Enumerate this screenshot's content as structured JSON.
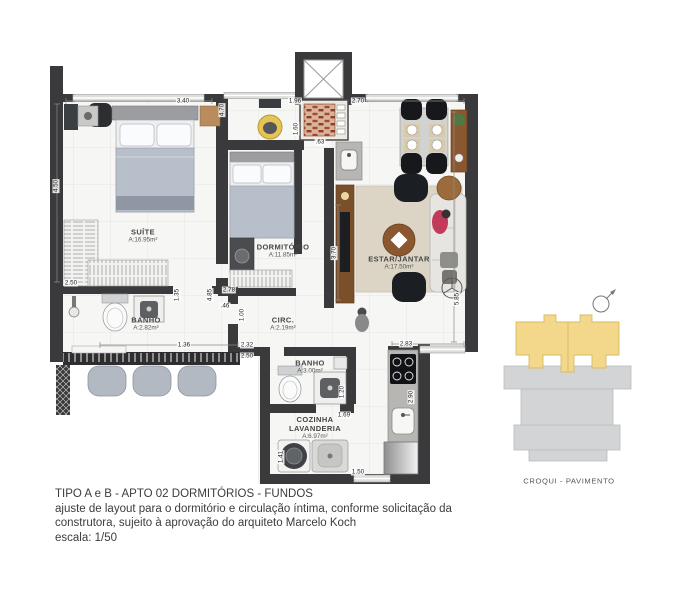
{
  "plan": {
    "rooms": [
      {
        "name": "SUÍTE",
        "area": "A:16.95m²",
        "x": 143,
        "y": 236
      },
      {
        "name": "DORMITÓRIO",
        "area": "A:11.85m²",
        "x": 283,
        "y": 251
      },
      {
        "name": "ESTAR/JANTAR",
        "area": "A:17.50m²",
        "x": 399,
        "y": 263
      },
      {
        "name": "BANHO",
        "area": "A:2.82m²",
        "x": 146,
        "y": 324
      },
      {
        "name": "CIRC.",
        "area": "A:2.19m²",
        "x": 283,
        "y": 324
      },
      {
        "name": "BANHO",
        "area": "A:3.00m²",
        "x": 310,
        "y": 367
      },
      {
        "name": "COZINHA",
        "name2": "LAVANDERIA",
        "area": "A:6.97m²",
        "x": 315,
        "y": 428
      }
    ],
    "dimensions": [
      {
        "text": "3.40",
        "x": 183,
        "y": 101,
        "v": false
      },
      {
        "text": "4.70",
        "x": 222,
        "y": 110,
        "v": true
      },
      {
        "text": "1.96",
        "x": 295,
        "y": 101,
        "v": false
      },
      {
        "text": "2.70",
        "x": 358,
        "y": 101,
        "v": false
      },
      {
        "text": "1.60",
        "x": 296,
        "y": 129,
        "v": true
      },
      {
        "text": ".63",
        "x": 320,
        "y": 142,
        "v": false
      },
      {
        "text": "4.50",
        "x": 56,
        "y": 186,
        "v": true
      },
      {
        "text": "2.50",
        "x": 71,
        "y": 283,
        "v": false
      },
      {
        "text": "1.35",
        "x": 177,
        "y": 295,
        "v": true
      },
      {
        "text": "4.85",
        "x": 210,
        "y": 295,
        "v": true
      },
      {
        "text": "2.78",
        "x": 229,
        "y": 290,
        "v": false
      },
      {
        "text": ".46",
        "x": 225,
        "y": 306,
        "v": false
      },
      {
        "text": "1.00",
        "x": 242,
        "y": 315,
        "v": true
      },
      {
        "text": "3.70",
        "x": 334,
        "y": 253,
        "v": true
      },
      {
        "text": "5.85",
        "x": 457,
        "y": 299,
        "v": true
      },
      {
        "text": "1.36",
        "x": 184,
        "y": 345,
        "v": false
      },
      {
        "text": "2.32",
        "x": 247,
        "y": 345,
        "v": false
      },
      {
        "text": "2.50",
        "x": 247,
        "y": 356,
        "v": false
      },
      {
        "text": "2.83",
        "x": 406,
        "y": 344,
        "v": false
      },
      {
        "text": "1.20",
        "x": 342,
        "y": 392,
        "v": true
      },
      {
        "text": "1.69",
        "x": 344,
        "y": 415,
        "v": false
      },
      {
        "text": "2.90",
        "x": 411,
        "y": 397,
        "v": true
      },
      {
        "text": "1.41",
        "x": 281,
        "y": 457,
        "v": true
      },
      {
        "text": "1.50",
        "x": 358,
        "y": 472,
        "v": false
      }
    ]
  },
  "croqui": {
    "label": "CROQUI - PAVIMENTO"
  },
  "caption": {
    "line1": "TIPO A e B - APTO 02  DORMITÓRIOS - FUNDOS",
    "line2": "ajuste de layout para o dormitório e circulação íntima, conforme solicitação da",
    "line3": "construtora, sujeito à aprovação do arquiteto Marcelo Koch",
    "line4": "escala: 1/50"
  },
  "colors": {
    "wall": "#3a3a3c",
    "floor": "#f6f6f4",
    "grid": "#e5e5e3",
    "croqui_highlight": "#f3d88c",
    "croqui_building": "#d2d4d6",
    "wood": "#8a5730",
    "dark_furniture": "#1b1e23"
  }
}
